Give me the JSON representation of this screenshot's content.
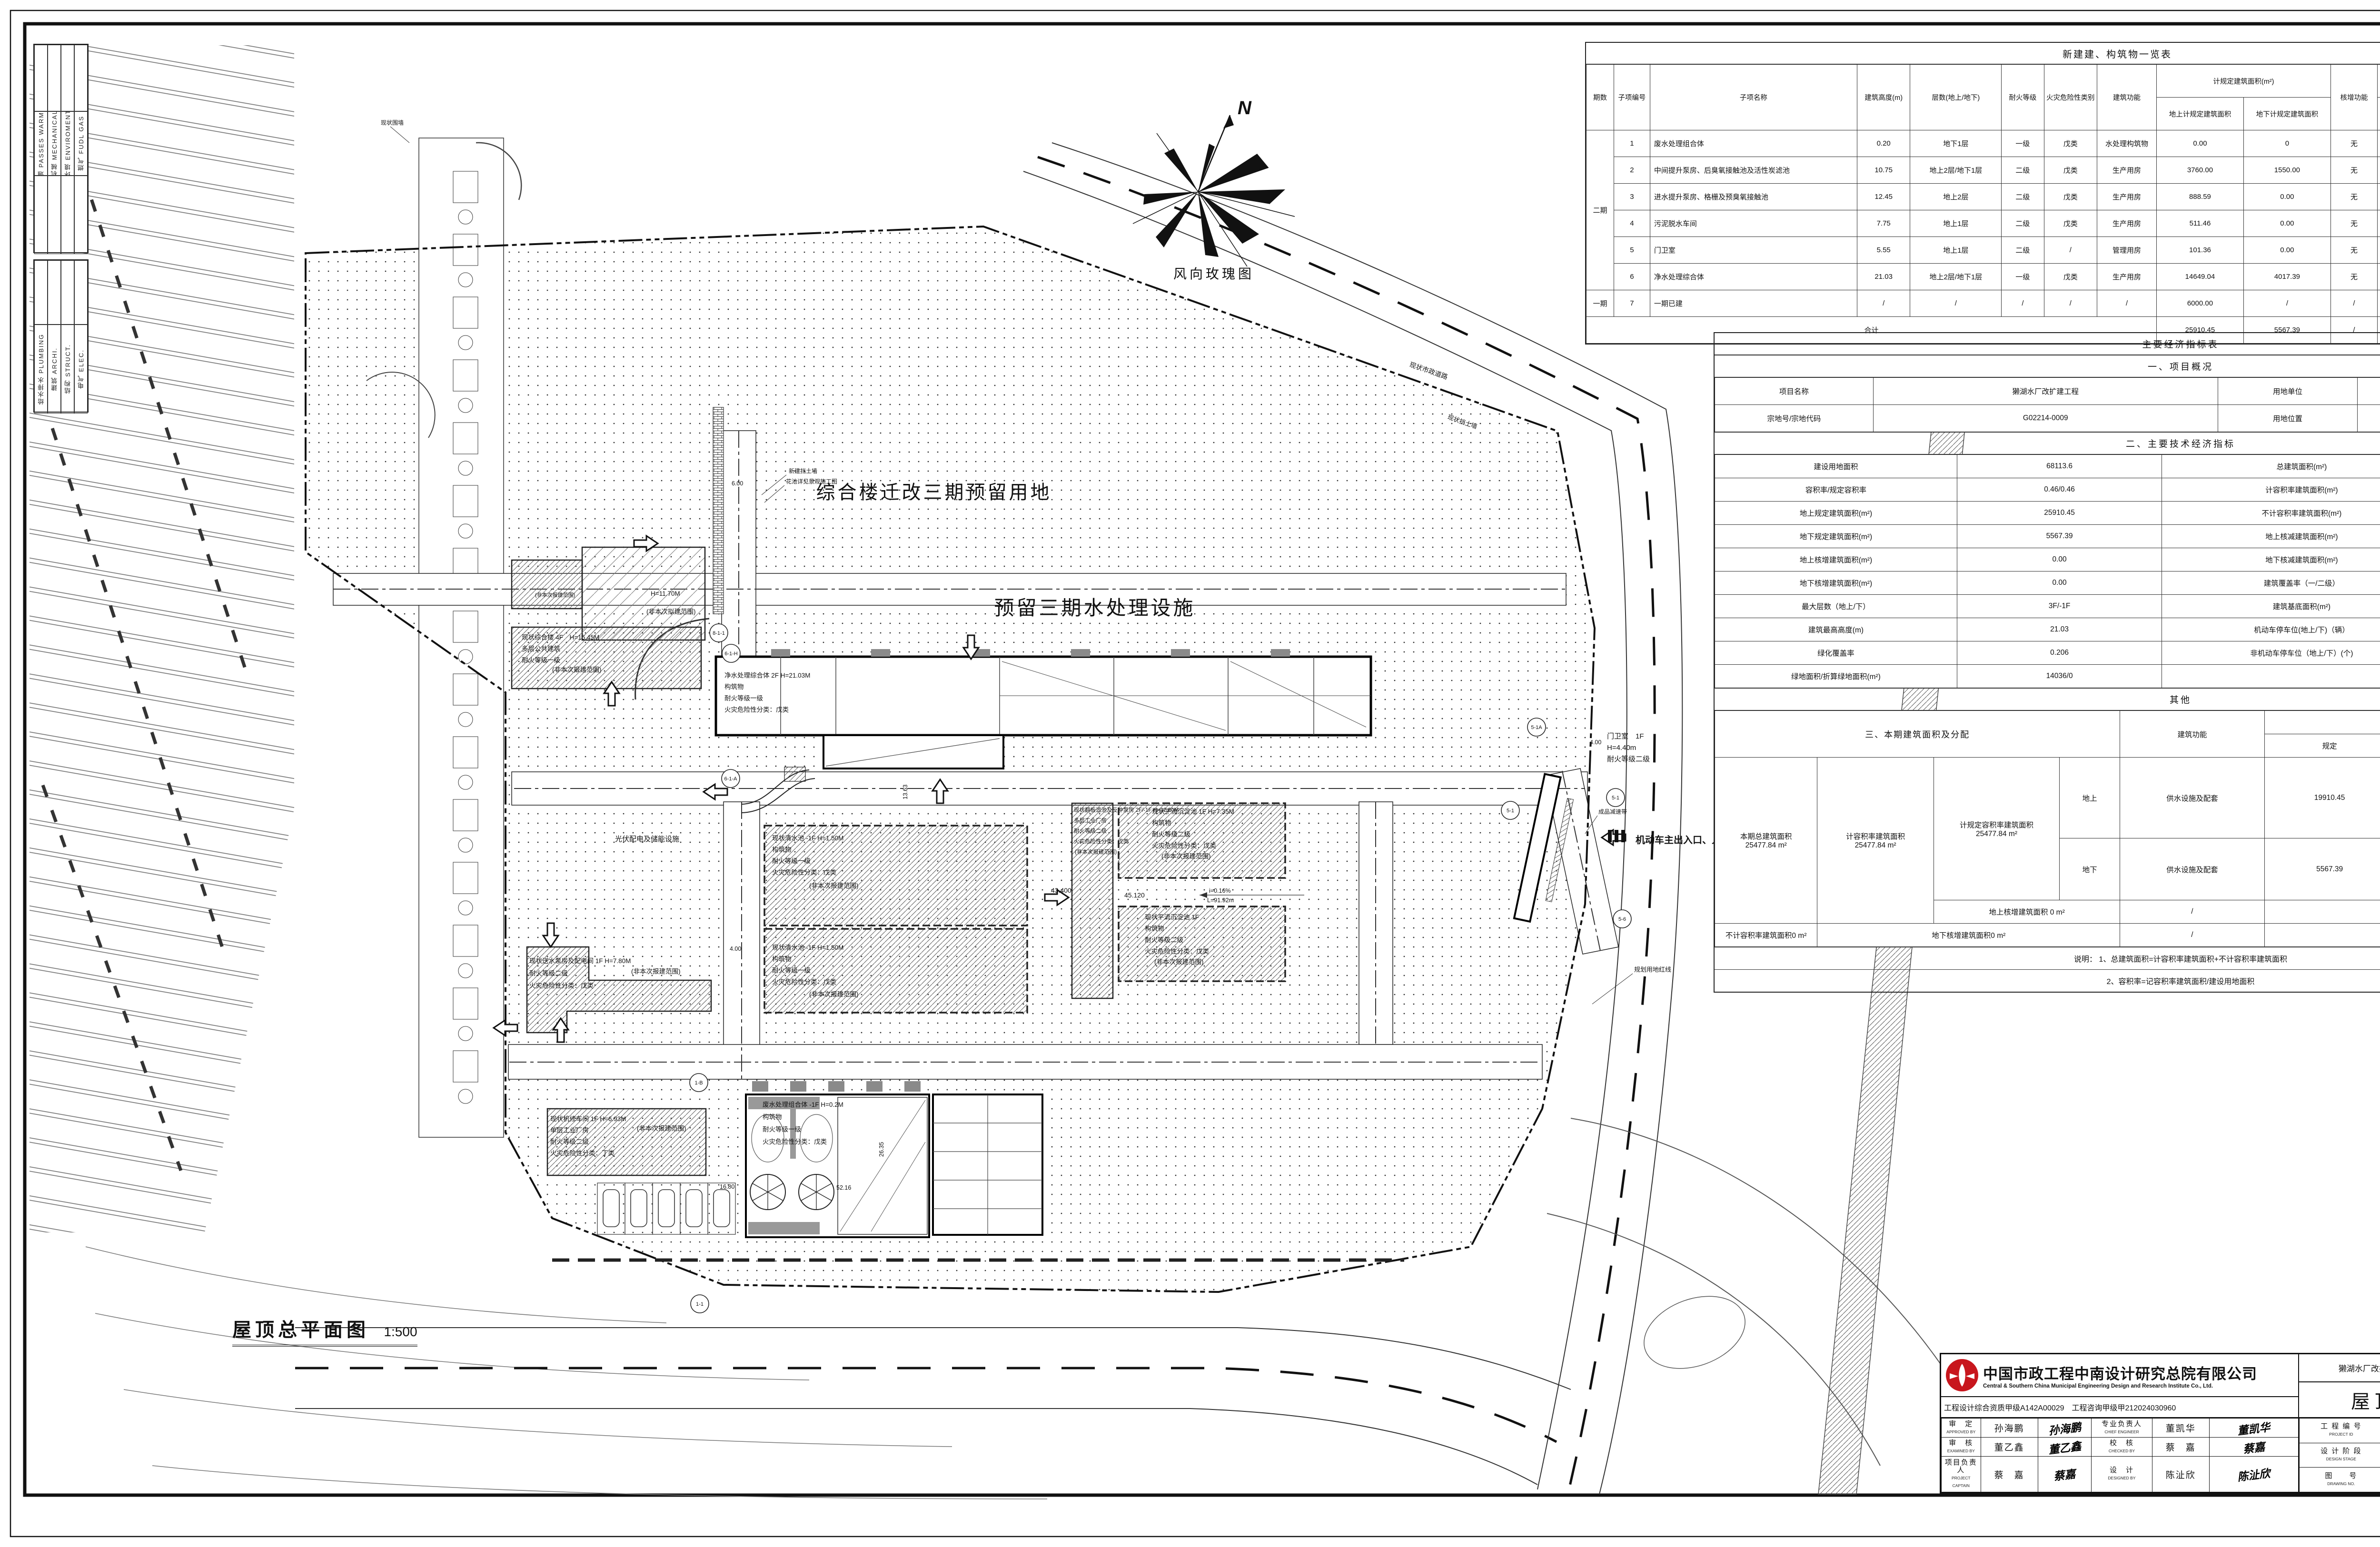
{
  "sheet": {
    "caption_title": "屋顶总平面图",
    "caption_scale": "1:500",
    "wind_rose_label": "风向玫瑰图",
    "north_label": "N"
  },
  "disciplines": {
    "group1": [
      "暖通 PASSES WARMLY",
      "机械 MECHANICAL",
      "环境 ENVIROMENT",
      "燃气 FUDL GAS"
    ],
    "group2": [
      "给水排水 PLUMBING",
      "建筑 ARCHI.",
      "结构 STRUCT.",
      "电气 ELEC."
    ]
  },
  "building_table": {
    "title": "新建建、构筑物一览表",
    "headers": {
      "phase": "期数",
      "no": "子项编号",
      "name": "子项名称",
      "height": "建筑高度(m)",
      "floors": "层数(地上/地下)",
      "fire": "耐火等级",
      "hazard": "火灾危险性类别",
      "func": "建筑功能",
      "area1": "计规定建筑面积(m²)",
      "area1a": "地上计规定建筑面积",
      "area1b": "地下计规定建筑面积",
      "addfunc": "核增功能",
      "area2": "计核增建筑面积(m²)",
      "area2a": "地上核增建筑面积",
      "area2b": "地下核增建筑面积",
      "base": "基底面积(m²)",
      "note": "备注"
    },
    "rows": [
      {
        "phase": "二期",
        "no": "1",
        "name": "废水处理组合体",
        "height": "0.20",
        "floors": "地下1层",
        "fire": "一级",
        "hazard": "戊类",
        "func": "水处理构筑物",
        "a1a": "0.00",
        "a1b": "0",
        "add": "无",
        "a2a": "0.00",
        "a2b": "0.00",
        "base": "0.00",
        "note": ""
      },
      {
        "phase": "",
        "no": "2",
        "name": "中间提升泵房、后臭氧接触池及活性炭滤池",
        "height": "10.75",
        "floors": "地上2层/地下1层",
        "fire": "二级",
        "hazard": "戊类",
        "func": "生产用房",
        "a1a": "3760.00",
        "a1b": "1550.00",
        "add": "无",
        "a2a": "0.00",
        "a2b": "0.00",
        "base": "1625.00",
        "note": ""
      },
      {
        "phase": "",
        "no": "3",
        "name": "进水提升泵房、格栅及预臭氧接触池",
        "height": "12.45",
        "floors": "地上2层",
        "fire": "二级",
        "hazard": "戊类",
        "func": "生产用房",
        "a1a": "888.59",
        "a1b": "0.00",
        "add": "无",
        "a2a": "0.00",
        "a2b": "0.00",
        "base": "406.57",
        "note": ""
      },
      {
        "phase": "",
        "no": "4",
        "name": "污泥脱水车间",
        "height": "7.75",
        "floors": "地上1层",
        "fire": "二级",
        "hazard": "戊类",
        "func": "生产用房",
        "a1a": "511.46",
        "a1b": "0.00",
        "add": "无",
        "a2a": "0.00",
        "a2b": "0.00",
        "base": "504.46",
        "note": ""
      },
      {
        "phase": "",
        "no": "5",
        "name": "门卫室",
        "height": "5.55",
        "floors": "地上1层",
        "fire": "二级",
        "hazard": "/",
        "func": "管理用房",
        "a1a": "101.36",
        "a1b": "0.00",
        "add": "无",
        "a2a": "",
        "a2b": "0.00",
        "base": "99.50",
        "note": ""
      },
      {
        "phase": "",
        "no": "6",
        "name": "净水处理综合体",
        "height": "21.03",
        "floors": "地上2层/地下1层",
        "fire": "一级",
        "hazard": "戊类",
        "func": "生产用房",
        "a1a": "14649.04",
        "a1b": "4017.39",
        "add": "无",
        "a2a": "0.00",
        "a2b": "0.00",
        "base": "6949.67",
        "note": ""
      },
      {
        "phase": "一期",
        "no": "7",
        "name": "一期已建",
        "height": "/",
        "floors": "/",
        "fire": "/",
        "hazard": "/",
        "func": "/",
        "a1a": "6000.00",
        "a1b": "/",
        "add": "/",
        "a2a": "/",
        "a2b": "/",
        "base": "6000.00",
        "note": ""
      }
    ],
    "total": {
      "label": "合计",
      "a1a": "25910.45",
      "a1b": "5567.39",
      "add": "/",
      "a2a": "0.00",
      "a2b": "0.00",
      "base": "15585.20",
      "note": ""
    }
  },
  "econ": {
    "title": "主要经济指标表",
    "sec1": "一、项目概况",
    "overview": [
      [
        "项目名称",
        "獭湖水厂改扩建工程",
        "用地单位",
        "深圳市深水龙岗水务集团有限公司"
      ],
      [
        "宗地号/宗地代码",
        "G02214-0009",
        "用地位置",
        "龙岗镇同乐村"
      ]
    ],
    "sec2": "二、主要技术经济指标",
    "indicators": [
      [
        "建设用地面积",
        "68113.6",
        "总建筑面积(m²)",
        "31477.84"
      ],
      [
        "容积率/规定容积率",
        "0.46/0.46",
        "计容积率建筑面积(m²)",
        "31477.84"
      ],
      [
        "地上规定建筑面积(m²)",
        "25910.45",
        "不计容积率建筑面积(m²)",
        "0.00"
      ],
      [
        "地下规定建筑面积(m²)",
        "5567.39",
        "地上核减建筑面积(m²)",
        "0.00"
      ],
      [
        "地上核增建筑面积(m²)",
        "0.00",
        "地下核减建筑面积(m²)",
        "0.00"
      ],
      [
        "地下核增建筑面积(m²)",
        "0.00",
        "建筑覆盖率（一/二级）",
        "0.23"
      ],
      [
        "最大层数（地上/下）",
        "3F/-1F",
        "建筑基底面积(m²)",
        "15585.2"
      ],
      [
        "建筑最高高度(m)",
        "21.03",
        "机动车停车位(地上/下)（辆）",
        "40/0"
      ],
      [
        "绿化覆盖率",
        "0.206",
        "非机动车停车位（地上/下）(个)",
        "10"
      ],
      [
        "绿地面积/折算绿地面积(m²)",
        "14036/0",
        "",
        ""
      ]
    ],
    "other": "其他",
    "sec3": "三、本期建筑面积及分配",
    "alloc": {
      "col_func": "建筑功能",
      "col_area": "建筑面积m²",
      "col_plan": "规定",
      "col_ded": "核减",
      "col_sum": "合计",
      "total_label": "本期总建筑面积",
      "total_value": "25477.84  m²",
      "far_label": "计容积率建筑面积",
      "far_value": "25477.84  m²",
      "far2_label": "计规定容积率建筑面积",
      "far2_value": "25477.84  m²",
      "above": "地上",
      "below": "地下",
      "func_value": "供水设施及配套",
      "above_vals": [
        "19910.45",
        "0.00",
        "19910.45"
      ],
      "below_vals": [
        "5567.39",
        "0",
        "5567.39"
      ],
      "add_above": "地上核增建筑面积  0  m²",
      "add_above_f": "/",
      "add_above_s": "0",
      "nofar": "不计容积率建筑面积0  m²",
      "add_below": "地下核增建筑面积0  m²",
      "add_below_f": "/",
      "add_below_s": "0"
    },
    "note1": "说明：  1、总建筑面积=计容积率建筑面积+不计容积率建筑面积",
    "note2": "2、容积率=记容积率建筑面积/建设用地面积"
  },
  "titleblock": {
    "company_cn": "中国市政工程中南设计研究总院有限公司",
    "company_en": "Central & Southern China Municipal Engineering Design and Research Institute Co., Ltd.",
    "cert": "工程设计综合资质甲级A142A00029　工程咨询甲级甲212024030960",
    "project": "獭湖水厂改扩建工程设计采购施工总承包(EPC)",
    "category": "总平面图",
    "drawing": "屋顶总平面图",
    "approvals": [
      {
        "label": "审　定",
        "en": "APPROVED BY",
        "name": "孙海鹏",
        "sig": "孙海鹏"
      },
      {
        "label": "专业负责人",
        "en": "CHIEF ENGINEER",
        "name": "董凯华",
        "sig": "董凯华"
      },
      {
        "label": "审　核",
        "en": "EXAMINED BY",
        "name": "董乙鑫",
        "sig": "董乙鑫"
      },
      {
        "label": "校　核",
        "en": "CHECKED BY",
        "name": "蔡　嘉",
        "sig": "蔡嘉"
      },
      {
        "label": "项目负责人",
        "en": "PROJECT CAPTAIN",
        "name": "蔡　嘉",
        "sig": "蔡嘉"
      },
      {
        "label": "设　计",
        "en": "DESIGNED BY",
        "name": "陈沚欣",
        "sig": "陈沚欣"
      }
    ],
    "meta": {
      "pid_label": "工 程 编 号",
      "pid_en": "PROJECT ID",
      "pid": "2025DS-150",
      "date_label": "日　　期",
      "date_en": "DATE",
      "date": "2026.03",
      "stage_label": "设 计 阶 段",
      "stage_en": "DESIGN STAGE",
      "stage": "施工图",
      "rev_label": "版本号",
      "rev_en": "REVISION",
      "rev": "○",
      "dno_label": "图　　号",
      "dno_en": "DRAWING NO.",
      "dno": "建-T-02"
    }
  },
  "site": {
    "big1": "综合楼迁改三期预留用地",
    "big2": "预留三期水处理设施",
    "pv": "光伏配电及储能设施",
    "zhs": [
      "现状综合楼 4F　H=15.45M",
      "多层公共建筑",
      "耐火等级一级",
      "(非本次报建范围)"
    ],
    "pump": [
      "现状送水泵房及配电间 1F H=7.80M",
      "耐火等级二级",
      "火灾危险性分类：戊类",
      "(非本次报建范围)"
    ],
    "repair": [
      "现状机修车间 1F H=6.93M",
      "单层工业厂房",
      "耐火等级二级",
      "火灾危险性分类：丁类",
      "(非本次报建范围)"
    ],
    "cw": [
      "现状清水池 -1F H=1.50M",
      "构筑物",
      "耐火等级一级",
      "火灾危险性分类：戊类",
      "(非本次报建范围)"
    ],
    "filter": [
      "现状翻板滤池及反冲泵房 2F/-1F H=12.00M",
      "多层工业厂房",
      "耐火等级二级",
      "火灾危险性分类：戊类",
      "(非本次报建范围)"
    ],
    "sed1": [
      "现状平流沉淀池 1F H=7.35M",
      "构筑物",
      "耐火等级二级",
      "火灾危险性分类：戊类",
      "(非本次报建范围)"
    ],
    "sed2": [
      "现状平流沉淀池 1F",
      "构筑物",
      "耐火等级二级",
      "火灾危险性分类：戊类",
      "(非本次报建范围)"
    ],
    "jingshui": [
      "净水处理综合体 2F H=21.03M",
      "构筑物",
      "耐火等级一级",
      "火灾危险性分类：戊类"
    ],
    "feishui": [
      "废水处理组合体 -1F H=0.2M",
      "构筑物",
      "耐火等级一级",
      "火灾危险性分类：戊类"
    ],
    "gate": [
      "门卫室　1F",
      "H=4.40m",
      "耐火等级二级"
    ],
    "wallnote": [
      "H=11.70M",
      "(非本次拟建范围)"
    ],
    "entrance": "机动车主出入口、人行出主入口",
    "redline": "规划用地红线",
    "speedbump": "成品减速带",
    "wall_new": "新建挡土墙",
    "flowerbed": "花池详见景观施工图",
    "road_exist": "现状市政道路",
    "wall_exist": "现状挡土墙",
    "fence_exist": "现状围墙",
    "dims": {
      "d600": "6.00",
      "d400": "4.00",
      "e1": "43.400",
      "e2": "45.120",
      "slope": "i=0.16%",
      "slen": "L=91.92m",
      "d1680": "16.80",
      "d5216": "52.16",
      "d1363": "13.63",
      "d2635": "26.35"
    },
    "markers": [
      "8-1-1",
      "6-1-H",
      "6-1-A",
      "1-B",
      "1-1",
      "5-1",
      "5-1A",
      "5-6"
    ]
  }
}
